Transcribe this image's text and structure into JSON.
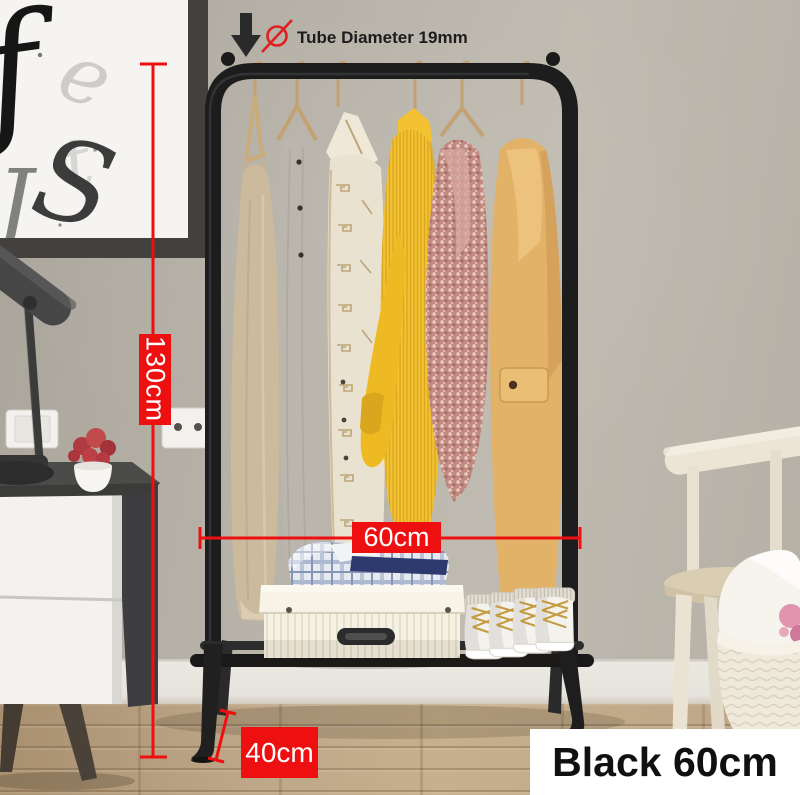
{
  "annotations": {
    "tube_diameter_label": "Tube Diameter 19mm",
    "height_label": "130cm",
    "width_label": "60cm",
    "depth_label": "40cm",
    "variant_label": "Black 60cm"
  },
  "icons": {
    "down_arrow_icon": "↓",
    "diameter_icon": "Ø"
  },
  "colors": {
    "annotation_red": "#ee1010",
    "annotation_text": "#ffffff",
    "variant_bg": "#ffffff",
    "variant_text": "#101010",
    "rack_black": "#1d1d1d",
    "wall": "#b7b2a8",
    "floor_wood": "#b99f7d"
  }
}
